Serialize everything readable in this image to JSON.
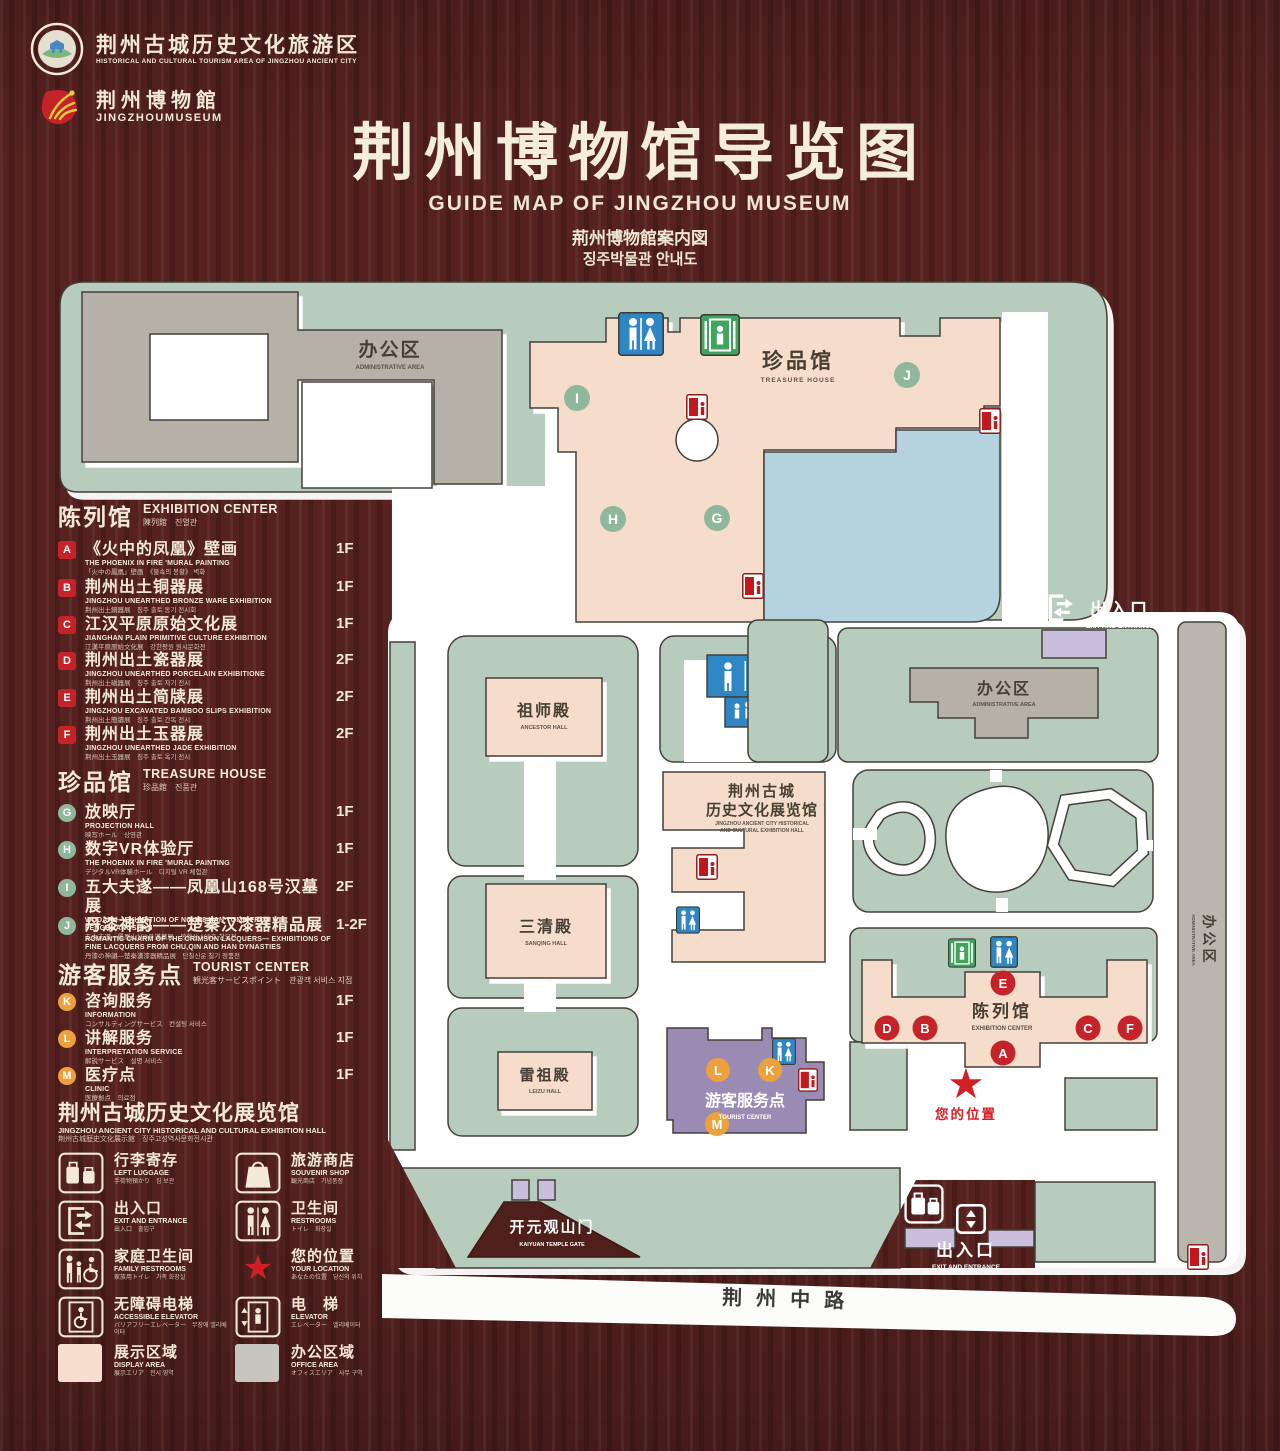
{
  "colors": {
    "wood": "#562220",
    "cream": "#f2e9d6",
    "map_green": "#b7ccbd",
    "map_pink": "#f6dcca",
    "map_gray": "#b5b1a6",
    "map_blue": "#b5d2df",
    "map_purple": "#c9bedb",
    "tourist_purple": "#9a8bb5",
    "sign_blue": "#2f86c5",
    "sign_green": "#3fa45c",
    "sign_red": "#c0181c",
    "badge_red": "#c5232a",
    "badge_green": "#8fb79b",
    "badge_orange": "#eda13c"
  },
  "header": {
    "logo1": {
      "zh": "荆州古城历史文化旅游区",
      "en": "HISTORICAL AND CULTURAL TOURISM AREA OF JINGZHOU ANCIENT CITY"
    },
    "logo2": {
      "zh": "荆州博物館",
      "en": "JINGZHOUMUSEUM"
    },
    "title": "荆州博物馆导览图",
    "subtitle_en": "GUIDE MAP OF JINGZHOU MUSEUM",
    "subtitle_jp": "荊州博物館案内図",
    "subtitle_kr": "징주박물관 안내도"
  },
  "legend": {
    "sections": [
      {
        "zh": "陈列馆",
        "en": "EXHIBITION CENTER",
        "sub": "陳列館　진열관",
        "items": [
          {
            "key": "A",
            "zh": "《火中的凤凰》壁画",
            "en": "THE PHOENIX IN FIRE 'MURAL PAINTING",
            "sub": "「火中の鳳凰」壁画　《불속의 봉황》 벽화",
            "floor": "1F"
          },
          {
            "key": "B",
            "zh": "荆州出土铜器展",
            "en": "JINGZHOU UNEARTHED BRONZE WARE EXHIBITION",
            "sub": "荆州出土銅器展　징주 출토 동기 전시회",
            "floor": "1F"
          },
          {
            "key": "C",
            "zh": "江汉平原原始文化展",
            "en": "JIANGHAN PLAIN PRIMITIVE CULTURE EXHIBITION",
            "sub": "江漢平原原始文化展　강한평원 원시문화전",
            "floor": "1F"
          },
          {
            "key": "D",
            "zh": "荆州出土瓷器展",
            "en": "JINGZHOU UNEARTHED PORCELAIN EXHIBITIONE",
            "sub": "荆州出土磁器展　징주 출토 자기 전시",
            "floor": "2F"
          },
          {
            "key": "E",
            "zh": "荆州出土简牍展",
            "en": "JINGZHOU EXCAVATED BAMBOO SLIPS EXHIBITION",
            "sub": "荆州出土簡牘展　징주 출토 간독 전시",
            "floor": "2F"
          },
          {
            "key": "F",
            "zh": "荆州出土玉器展",
            "en": "JINGZHOU UNEARTHED JADE EXHIBITION",
            "sub": "荆州出土玉器展　징주 출토 옥기 전시",
            "floor": "2F"
          }
        ]
      },
      {
        "zh": "珍品馆",
        "en": "TREASURE HOUSE",
        "sub": "珍品館　진품관",
        "items": [
          {
            "key": "G",
            "zh": "放映厅",
            "en": "PROJECTION HALL",
            "sub": "映写ホール　상영관",
            "floor": "1F"
          },
          {
            "key": "H",
            "zh": "数字VR体验厅",
            "en": "THE PHOENIX IN FIRE 'MURAL PAINTING",
            "sub": "デジタルVR体験ホール　디지털 VR 체험관",
            "floor": "1F"
          },
          {
            "key": "I",
            "zh": "五大夫遂——凤凰山168号汉墓展",
            "en": "WUDAFU—EXHIBITION OF NO.168 HAN TOMB FROM FENGHUANGSHAN",
            "sub": "五大夫遂—鳳凰山168号漢墓展　봉황산 168호 한묘전",
            "floor": "2F"
          },
          {
            "key": "J",
            "zh": "丹漆神韵——楚秦汉漆器精品展",
            "en": "ROMANTIC CHARM OF THE CRIMSON LACQUERS— EXHIBITIONS OF FINE LACQUERS FROM CHU,QIN AND HAN DYNASTIES",
            "sub": "丹漆の神韻—楚秦漢漆器精品展　단칠신운 칠기 정품전",
            "floor": "1-2F"
          }
        ]
      },
      {
        "zh": "游客服务点",
        "en": "TOURIST CENTER",
        "sub": "観光客サービスポイント　관광객 서비스 지점",
        "items": [
          {
            "key": "K",
            "zh": "咨询服务",
            "en": "INFORMATION",
            "sub": "コンサルティングサービス　컨설팅 서비스",
            "floor": "1F"
          },
          {
            "key": "L",
            "zh": "讲解服务",
            "en": "INTERPRETATION SERVICE",
            "sub": "解説サービス　설명 서비스",
            "floor": "1F"
          },
          {
            "key": "M",
            "zh": "医疗点",
            "en": "CLINIC",
            "sub": "医療拠点　의료점",
            "floor": "1F"
          }
        ]
      }
    ],
    "hall": {
      "zh": "荆州古城历史文化展览馆",
      "en": "JINGZHOU ANCIENT CITY HISTORICAL AND CULTURAL EXHIBITION HALL",
      "sub": "荆州古城歴史文化展示館　징주고성역사문화전시관"
    },
    "icons": [
      {
        "zh": "行李寄存",
        "en": "LEFT LUGGAGE",
        "sub": "手荷物預かり　짐 보관"
      },
      {
        "zh": "旅游商店",
        "en": "SOUVENIR SHOP",
        "sub": "観光商店　기념품점"
      },
      {
        "zh": "出入口",
        "en": "EXIT AND ENTRANCE",
        "sub": "出入口　출입구"
      },
      {
        "zh": "卫生间",
        "en": "RESTROOMS",
        "sub": "トイレ　화장실"
      },
      {
        "zh": "家庭卫生间",
        "en": "FAMILY RESTROOMS",
        "sub": "家族用トイレ　가족 화장실"
      },
      {
        "zh": "您的位置",
        "en": "YOUR LOCATION",
        "sub": "あなたの位置　당신의 위치"
      },
      {
        "zh": "无障碍电梯",
        "en": "ACCESSIBLE ELEVATOR",
        "sub": "バリアフリーエレベーター　무장애 엘리베이터"
      },
      {
        "zh": "电　梯",
        "en": "ELEVATOR",
        "sub": "エレベーター　엘리베이터"
      },
      {
        "zh": "展示区域",
        "en": "DISPLAY AREA",
        "sub": "展示エリア　전시 영역"
      },
      {
        "zh": "办公区域",
        "en": "OFFICE AREA",
        "sub": "オフィスエリア　사무 구역"
      }
    ]
  },
  "map": {
    "admin": {
      "zh": "办公区",
      "en": "ADMINISTRATIVE AREA"
    },
    "treasure": {
      "zh": "珍品馆",
      "en": "TREASURE HOUSE"
    },
    "ancestor": {
      "zh": "祖师殿",
      "en": "ANCESTOR HALL"
    },
    "sanqing": {
      "zh": "三清殿",
      "en": "SANQING HALL"
    },
    "leizu": {
      "zh": "雷祖殿",
      "en": "LEIZU HALL"
    },
    "hall": {
      "zh1": "荆州古城",
      "zh2": "历史文化展览馆",
      "en1": "JINGZHOU ANCIENT CITY HISTORICAL",
      "en2": "AND CULTURAL EXHIBITION HALL"
    },
    "tourist": {
      "zh": "游客服务点",
      "en": "TOURIST CENTER"
    },
    "excenter": {
      "zh": "陈列馆",
      "en": "EXHIBITION CENTER"
    },
    "exit": {
      "zh": "出入口",
      "en": "EXIT AND ENTRANCE"
    },
    "gate": {
      "zh": "开元观山门",
      "en": "KAIYUAN TEMPLE GATE"
    },
    "your_location": "您的位置",
    "star": "★",
    "road": "荆州中路",
    "markers": {
      "A": "A",
      "B": "B",
      "C": "C",
      "D": "D",
      "E": "E",
      "F": "F",
      "G": "G",
      "H": "H",
      "I": "I",
      "J": "J",
      "K": "K",
      "L": "L",
      "M": "M"
    }
  }
}
